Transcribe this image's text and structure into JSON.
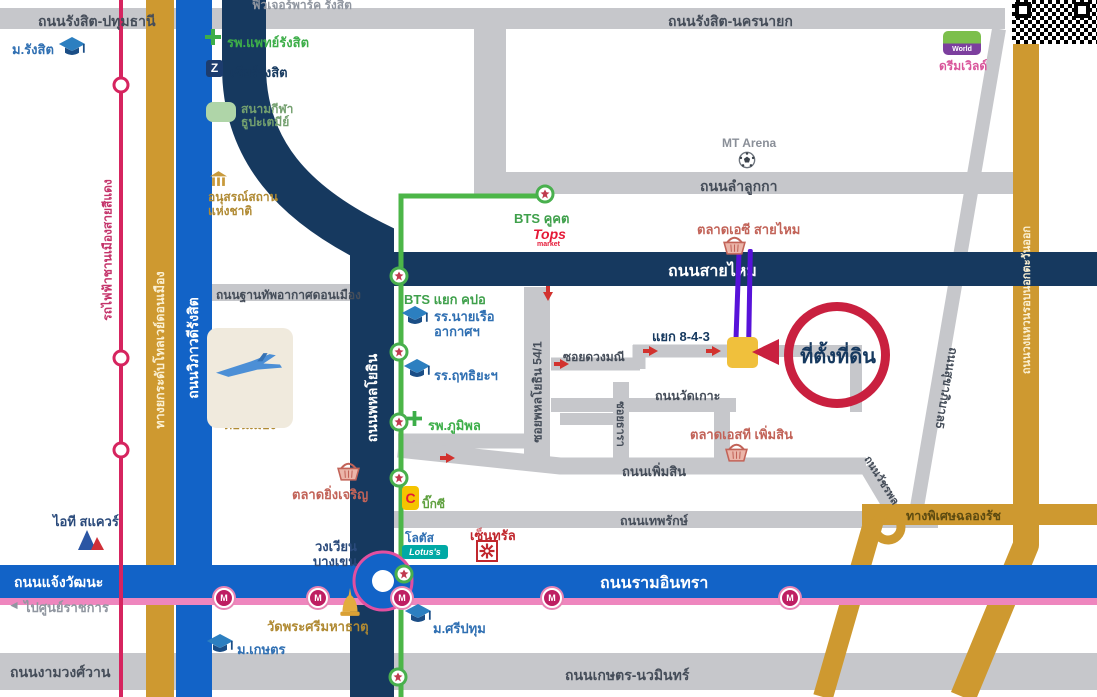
{
  "colors": {
    "road_gray": "#C6C7CB",
    "navy": "#16395F",
    "blue": "#1263C7",
    "gold": "#CE9930",
    "green_line": "#4CB648",
    "mrt_pink": "#EE86BE",
    "red_rail": "#D6245F",
    "purple": "#5712D9",
    "accent_red": "#C9203F",
    "site_yellow": "#F0C03C"
  },
  "roads": {
    "rangsit_pathum": "ถนนรังสิต-ปทุมธานี",
    "rangsit_nakhonnayok": "ถนนรังสิต-นครนายก",
    "lamlukka": "ถนนลำลูกกา",
    "saimai": "ถนนสายไหม",
    "thanthap": "ถนนฐานทัพอากาศดอนเมือง",
    "phahonyothin": "ถนนพหลโยธิน",
    "vibhavadi": "ถนนวิภาวดีรังสิต",
    "tollway": "ทางยกระดับโทลเวย์ดอนเมือง",
    "soi54": "ซอยพหลโยธิน 54/1",
    "duangmanee": "ซอยดวงมณี",
    "watkoh": "ถนนวัดเกาะ",
    "soithara": "ซอยธารา",
    "phoemsin": "ถนนเพิ่มสิน",
    "theparak": "ถนนเทพรักษ์",
    "watcharaphon": "ถนนวัชรพล",
    "sukhaphiban5": "ถนนสุขาภิบาล5",
    "chalongrat": "ทางพิเศษฉลองรัช",
    "outer_ring": "ถนนวงแหวนรอบนอกตะวันออก",
    "ramindra": "ถนนรามอินทรา",
    "chaengwattana": "ถนนแจ้งวัฒนะ",
    "ngamwongwan": "ถนนงามวงศ์วาน",
    "kaset_nawamin": "ถนนเกษตร-นวมินทร์"
  },
  "transit": {
    "red_line": "รถไฟฟ้าชานเมืองสายสีแดง",
    "bts_khukhot": "BTS คูคต",
    "bts_yaek_kpo": "BTS แยก คปอ",
    "mrt_letter": "M"
  },
  "annotation": {
    "site_label": "ที่ตั้งที่ดิน",
    "junction": "แยก 8-4-3"
  },
  "places": {
    "future_park": "ฟิวเจอร์พาร์ค รังสิต",
    "m_rangsit": "ม.รังสิต",
    "rp_rangsit": "รพ.แพทย์รังสิต",
    "zeer_z": "Z",
    "zeer": "เซียร์รังสิต",
    "stadium1": "สนามกีฬา",
    "stadium2": "ธูปะเตมีย์",
    "memorial1": "อนุสรณ์สถาน",
    "memorial2": "แห่งชาติ",
    "airport1": "ท่าอากาศยาน",
    "airport2": "ดอนเมือง",
    "mt_arena": "MT Arena",
    "tops1": "Tops",
    "tops2": "market",
    "market_ac": "ตลาดเอซี สายไหม",
    "dream_world_logo": "World",
    "dream_world": "ดรีมเวิลด์",
    "navy_academy1": "รร.นายเรือ",
    "navy_academy2": "อากาศฯ",
    "rittiya": "รร.ฤทธิยะฯ",
    "bhumibol": "รพ.ภูมิพล",
    "market_st": "ตลาดเอสที เพิ่มสิน",
    "market_ying": "ตลาดยิ่งเจริญ",
    "bigc_c": "C",
    "bigc": "บิ๊กซี",
    "lotus_th": "โลตัส",
    "lotus_en": "Lotus's",
    "central": "เซ็นทรัล",
    "roundabout1": "วงเวียน",
    "roundabout2": "บางเขน",
    "it_square": "ไอที สแควร์",
    "gov_center": "ไปศูนย์ราชการ",
    "wat_phrasri": "วัดพระศรีมหาธาตุ",
    "sripatum": "ม.ศรีปทุม",
    "kaset": "ม.เกษตร"
  }
}
